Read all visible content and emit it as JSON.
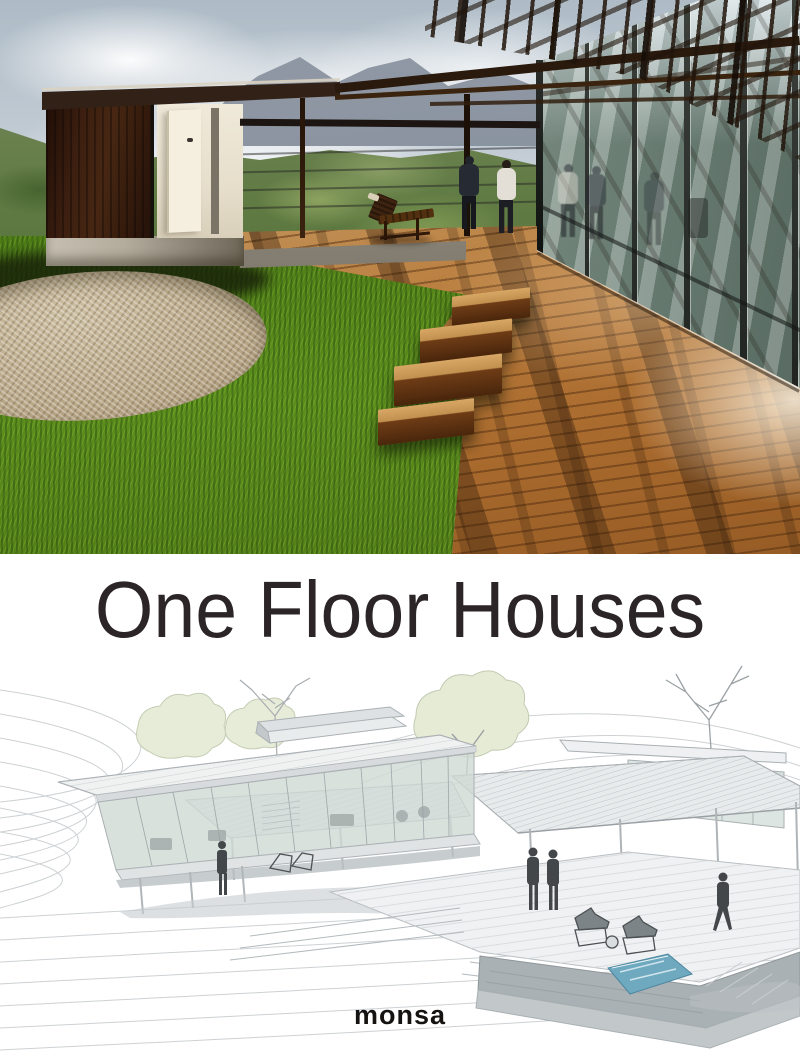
{
  "cover": {
    "title": "One Floor Houses",
    "publisher": "monsa",
    "colors": {
      "title_text": "#2c2527",
      "logo_text": "#151312",
      "sky_top": "#aebbc6",
      "sky_light": "#edf0f2",
      "mountain": "#8f98a4",
      "hillside_green": "#5f7a42",
      "house_wood": "#3c1f10",
      "roof_dark": "#241309",
      "concrete": "#b3ac9d",
      "glass_reflection": "#8fa396",
      "deck_wood": "#b97c3c",
      "grass_green": "#4c7a16",
      "gravel_beige": "#c3b394",
      "drawing_line": "#cdd1d4",
      "drawing_dark": "#9aa0a3",
      "pool_blue": "#6fa9bf",
      "figure_grey": "#43474a",
      "foliage_pale": "#e6ebd6"
    }
  }
}
